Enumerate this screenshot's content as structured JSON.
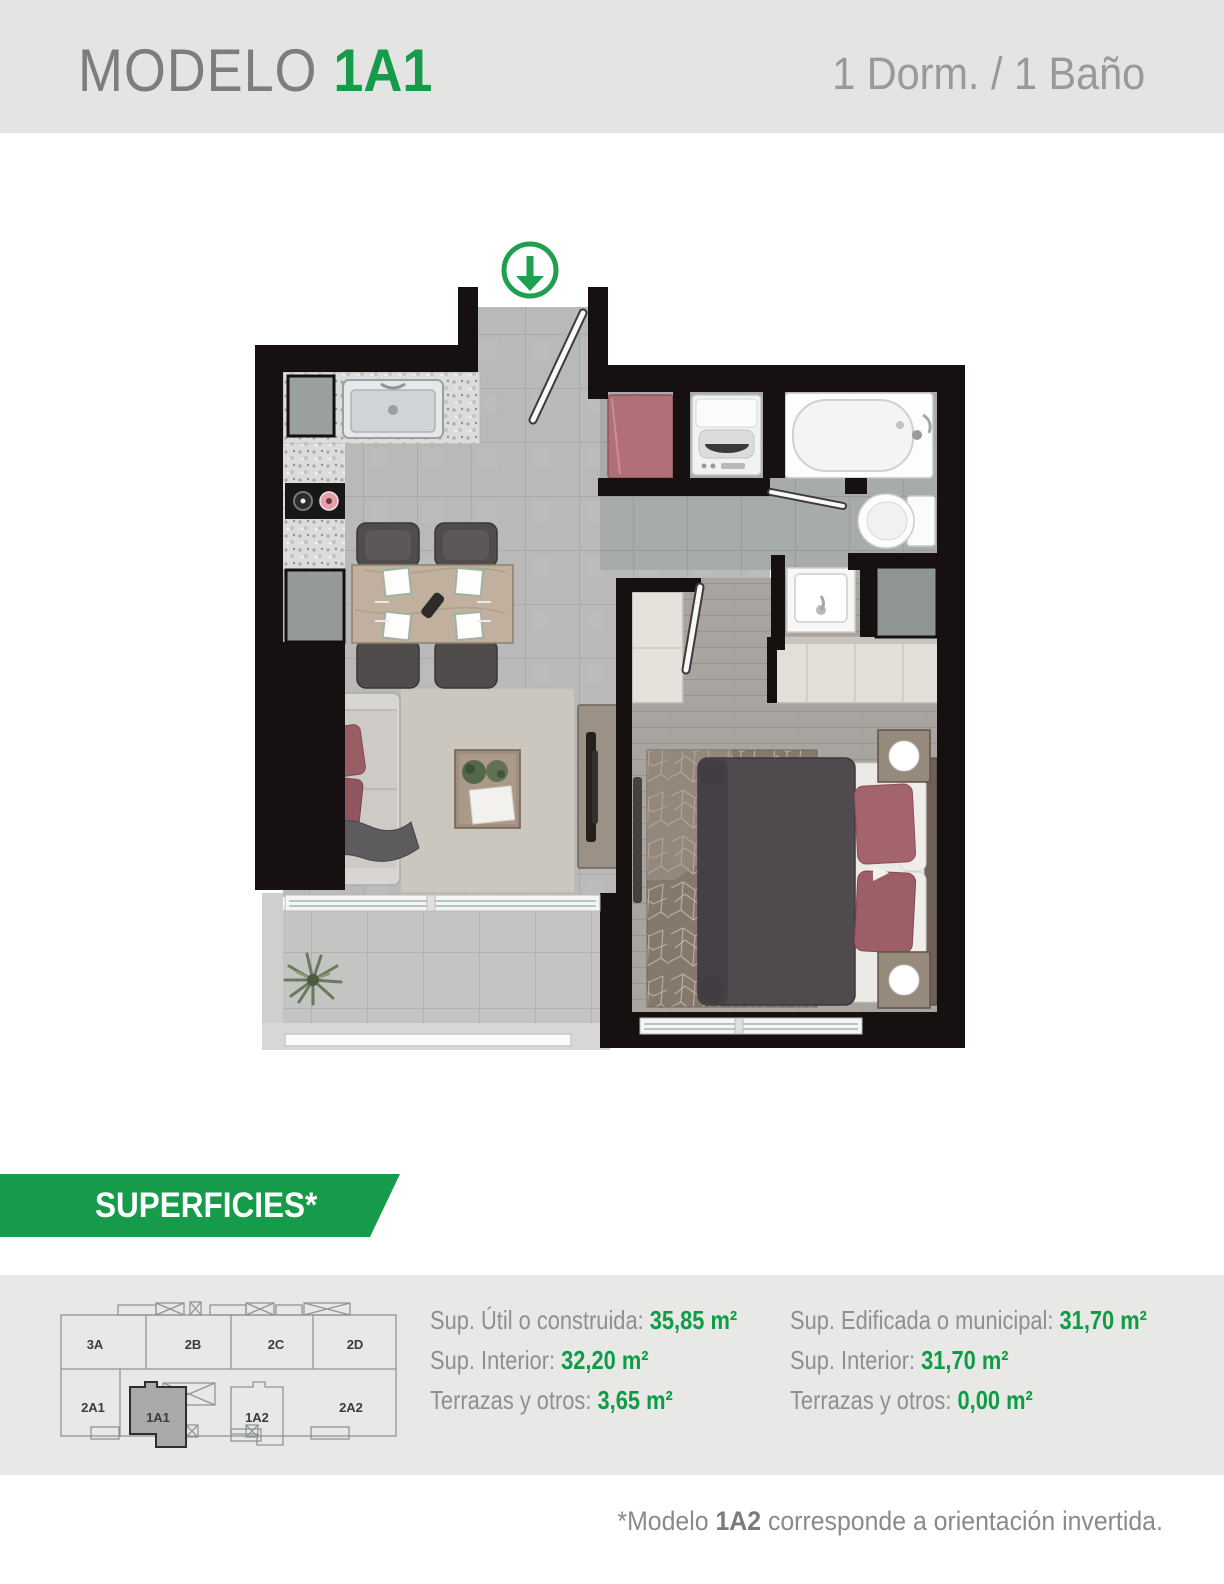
{
  "header": {
    "title_prefix": "MODELO ",
    "title_model": "1A1",
    "subtitle": "1 Dorm. / 1 Baño",
    "bg_color": "#e4e4e3",
    "model_color": "#159b4a"
  },
  "floorplan": {
    "entrance_arrow_icon": "arrow-down-circle",
    "arrow_color": "#1fa04e"
  },
  "superficies": {
    "banner_label": "SUPERFICIES*",
    "banner_color": "#159b4a",
    "label_color": "#8f8f8f",
    "value_color": "#0e9c46",
    "left_column": [
      {
        "label": "Sup. Útil o construida:",
        "value": "35,85 m²"
      },
      {
        "label": "Sup. Interior:",
        "value": "32,20 m²"
      },
      {
        "label": "Terrazas y otros:",
        "value": "3,65 m²"
      }
    ],
    "right_column": [
      {
        "label": "Sup. Edificada o municipal:",
        "value": "31,70 m²"
      },
      {
        "label": "Sup. Interior:",
        "value": "31,70 m²"
      },
      {
        "label": "Terrazas y otros:",
        "value": "0,00 m²"
      }
    ]
  },
  "keyplan": {
    "units_top": [
      "3A",
      "2B",
      "2C",
      "2D"
    ],
    "units_bottom": [
      "2A1",
      "1A1",
      "1A2",
      "2A2"
    ],
    "highlighted_unit": "1A1"
  },
  "footnote": {
    "prefix": "*Modelo ",
    "bold": "1A2",
    "suffix": " corresponde a orientación invertida."
  }
}
